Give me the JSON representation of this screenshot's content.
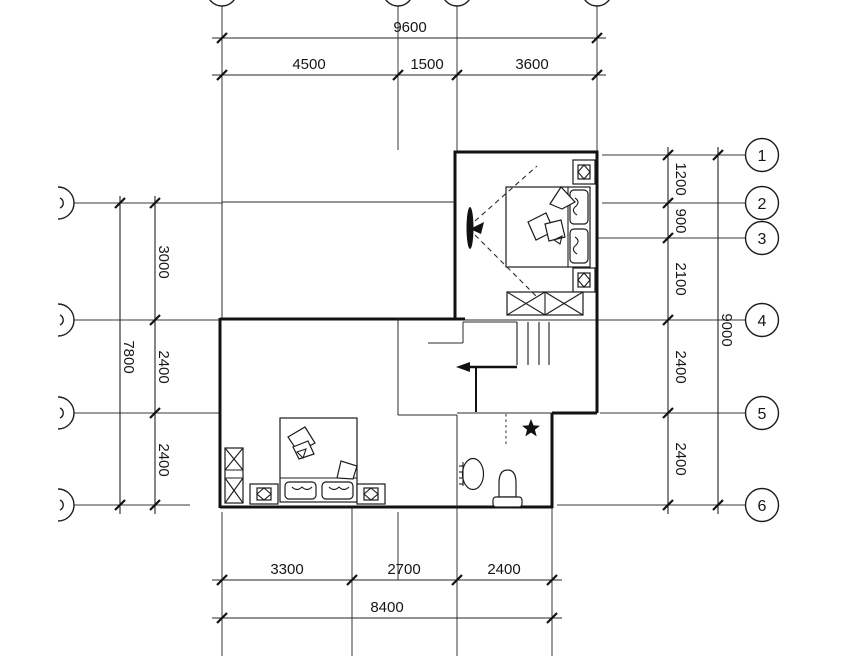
{
  "drawing": {
    "title": "second-floor-plan",
    "colors": {
      "line": "#1a1a1a",
      "background": "#ffffff"
    },
    "dims_top": {
      "overall": "9600",
      "segments": [
        "4500",
        "1500",
        "3600"
      ]
    },
    "dims_bottom": {
      "overall": "8400",
      "segments": [
        "3300",
        "2700",
        "2400"
      ]
    },
    "dims_right": {
      "overall": "9000",
      "segments": [
        "1200",
        "900",
        "2100",
        "2400",
        "2400"
      ]
    },
    "dims_left": {
      "overall": "7800",
      "segments": [
        "3000",
        "2400",
        "2400"
      ]
    },
    "grid_bubbles_right": [
      "1",
      "2",
      "3",
      "4",
      "5",
      "6"
    ]
  }
}
